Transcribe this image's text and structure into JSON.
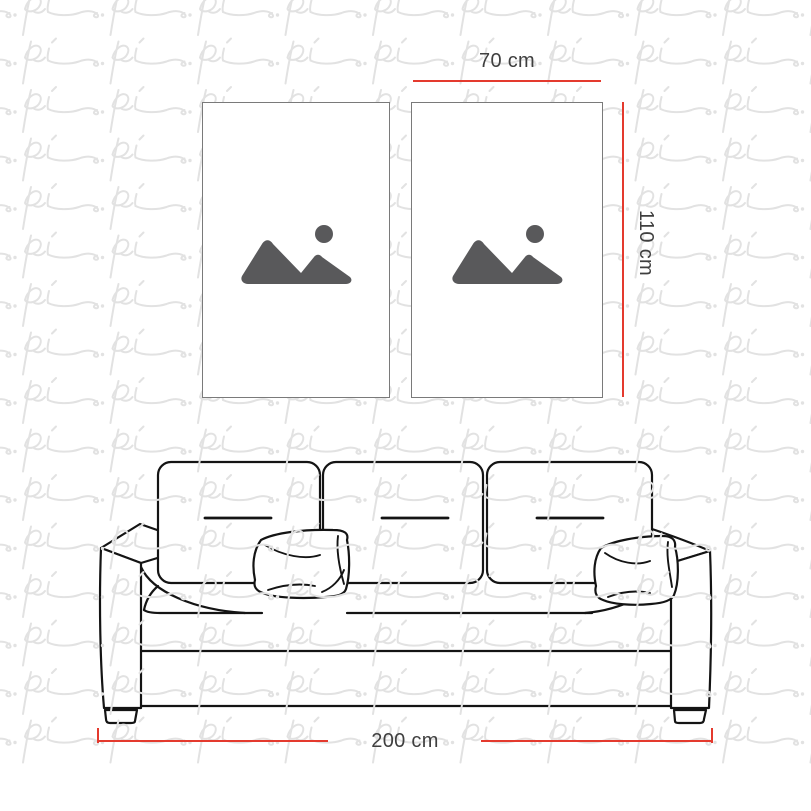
{
  "diagram": {
    "type": "product-size-guide",
    "frame_width_label": "70 cm",
    "frame_height_label": "110 cm",
    "sofa_width_label": "200 cm"
  },
  "watermark": {
    "text": "pi",
    "color": "#e2e2e2"
  },
  "colors": {
    "dimension_line": "#e43a2e",
    "dimension_text": "#3f3f3f",
    "frame_border": "#7a7a7a",
    "placeholder_icon": "#59595b",
    "sofa_outline": "#141414",
    "background": "#ffffff"
  },
  "icons": {
    "frame_placeholder": "image-placeholder-mountains-sun-icon"
  }
}
